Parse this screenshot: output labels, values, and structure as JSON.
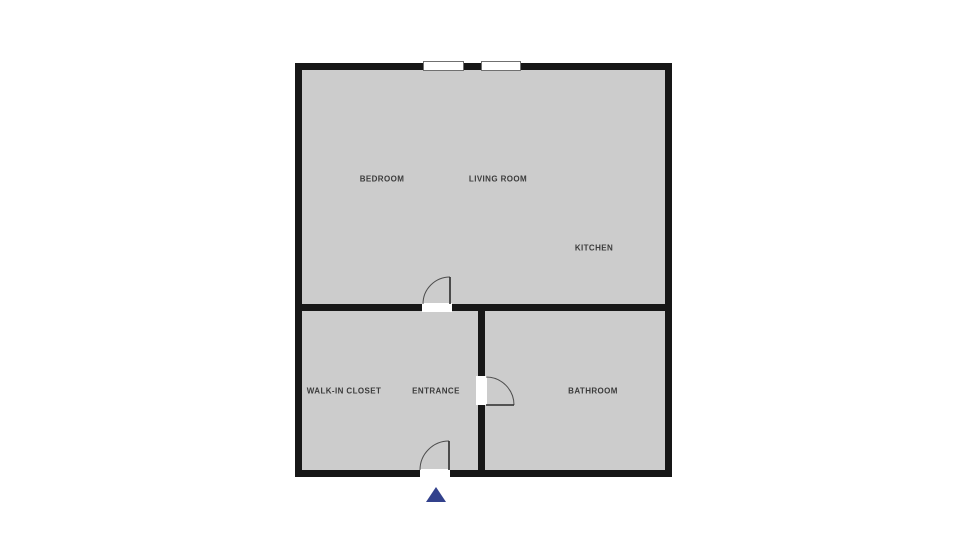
{
  "floorplan": {
    "title": "apartment-floor-plan",
    "rooms": [
      {
        "id": "bedroom",
        "label": "BEDROOM"
      },
      {
        "id": "living-room",
        "label": "LIVING ROOM"
      },
      {
        "id": "kitchen",
        "label": "KITCHEN"
      },
      {
        "id": "walk-in-closet",
        "label": "WALK-IN CLOSET"
      },
      {
        "id": "entrance",
        "label": "ENTRANCE"
      },
      {
        "id": "bathroom",
        "label": "BATHROOM"
      }
    ],
    "icons": {
      "entrance_arrow": "triangle-up"
    },
    "colors": {
      "background": "#ffffff",
      "floor": "#cccccc",
      "wall": "#171717",
      "door_arc": "#4d4d4d",
      "door_leaf": "#2b2b2b",
      "window_frame": "#707070",
      "label_text": "#3b3b3b",
      "entrance_arrow": "#32418c"
    }
  }
}
